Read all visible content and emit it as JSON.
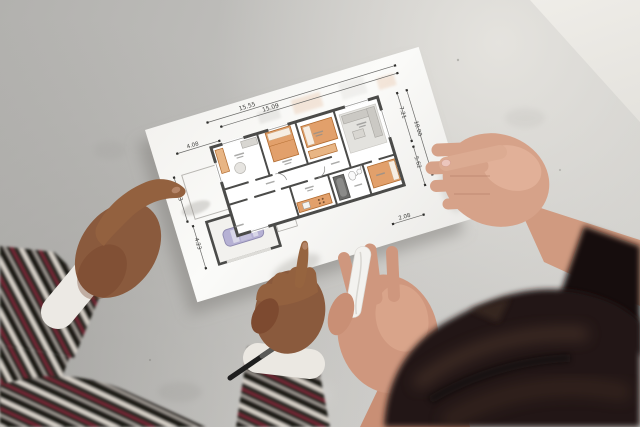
{
  "image": {
    "alt": "Top-down photo of two people holding an architectural floor plan sheet over a gray concrete floor; one dark-skinned hand points at the plan, a lighter-skinned hand with pink nails grips the right edge"
  },
  "blueprint": {
    "dims": {
      "top": [
        "15.55",
        "15.09"
      ],
      "upper_left": "4.08",
      "left": [
        "4.43",
        "4.23"
      ],
      "right": [
        "7.21",
        "10.00",
        "5.62"
      ],
      "bottom_right": "2.08"
    }
  },
  "palette": {
    "floor": "#c6c5c2",
    "paper": "#f9f9f7",
    "plan_wall": "#4b4b49",
    "furniture_accent": "#e2a06b",
    "car": "#b6b1d4",
    "skin_man": "#8a5a3d",
    "skin_woman": "#d3a088",
    "sweater_dark": "#2f2926",
    "sweater_cream": "#d8d2c9",
    "sweater_red": "#7c2434",
    "leather_jacket": "#201813",
    "nail_polish": "#ecc6bd"
  }
}
